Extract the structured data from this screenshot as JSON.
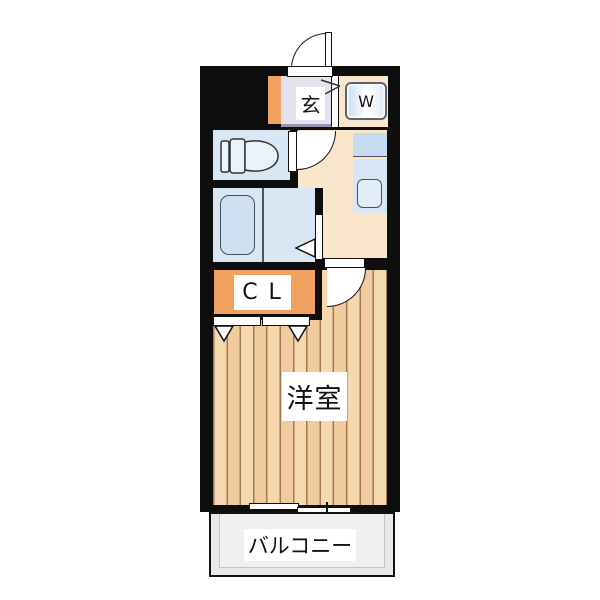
{
  "floorplan": {
    "title": "apartment-1k-floorplan",
    "labels": {
      "entrance": "玄",
      "washer": "W",
      "closet": "C L",
      "main_room": "洋室",
      "balcony": "バルコニー"
    },
    "rooms": [
      {
        "name": "entrance-genkan",
        "label": "玄"
      },
      {
        "name": "washing-machine-space",
        "label": "W"
      },
      {
        "name": "toilet-room",
        "label": ""
      },
      {
        "name": "bathroom",
        "label": ""
      },
      {
        "name": "kitchen-counter",
        "label": ""
      },
      {
        "name": "closet",
        "label": "C L"
      },
      {
        "name": "western-style-room",
        "label": "洋室"
      },
      {
        "name": "balcony",
        "label": "バルコニー"
      }
    ],
    "colors": {
      "wall_black": "#0e0e0e",
      "accent_orange": "#F2A25F",
      "water_blue": "#D9E7F5",
      "hall_cream": "#FAE7CB",
      "genkan_lavender": "#E4E2ED",
      "wood_floor": "#F6D8AE",
      "wood_stripe": "#A37A50",
      "balcony_gray": "#E9E9E9"
    }
  }
}
